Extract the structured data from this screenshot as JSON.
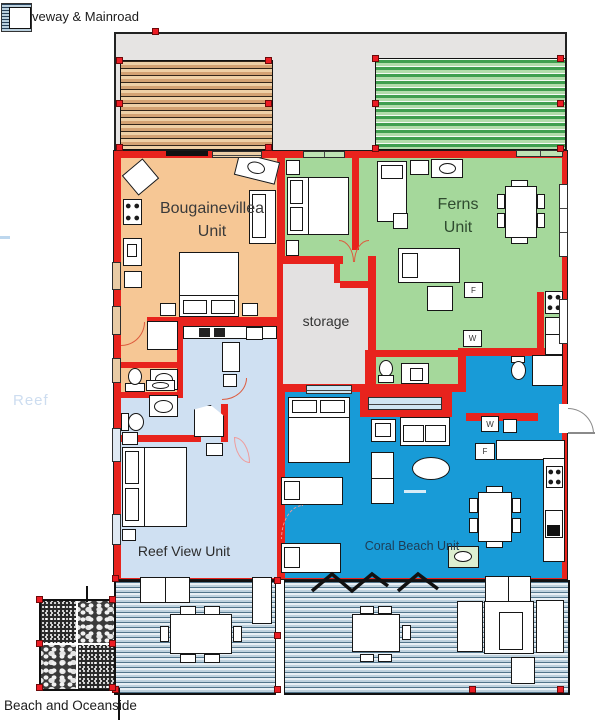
{
  "legend": {
    "label": "veway & Mainroad"
  },
  "units": {
    "bougainevillea": {
      "line1": "Bougainevillea",
      "line2": "Unit",
      "fill": "#f6c795"
    },
    "ferns": {
      "line1": "Ferns",
      "line2": "Unit",
      "fill": "#a5d89b"
    },
    "reef_view": {
      "name": "Reef View Unit",
      "fill": "#cfe0f2"
    },
    "coral_beach": {
      "name": "Coral Beach Unit",
      "fill": "#189bd7"
    }
  },
  "labels": {
    "storage": "storage",
    "reef": "Reef",
    "beach": "Beach and Oceanside"
  },
  "appliances": {
    "fridge": "F",
    "washer": "W"
  },
  "colors": {
    "wall_red": "#e8231d",
    "storage_fill": "#e3e1e1",
    "driveway_fill": "#e6e4e3",
    "carport_left_stripe": "#d3a273",
    "carport_right_stripe": "#3f9f4f",
    "deck_stripe": "#51748a",
    "door_arc": "#dd5a3d"
  }
}
